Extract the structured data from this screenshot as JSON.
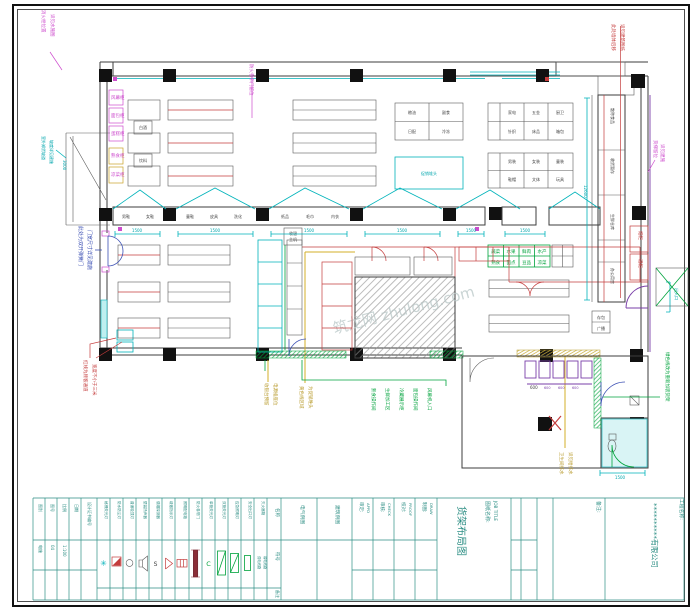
{
  "colors": {
    "wall": "#3d3d3d",
    "red": "#c43c3c",
    "cyan": "#00b3ba",
    "green": "#00a33c",
    "yellow": "#d3af2a",
    "magenta": "#cd4ccd",
    "purple": "#7a3fa8",
    "blue": "#3c50b4",
    "teal": "#2e8f85"
  },
  "tb": {
    "company": "**********有限公司",
    "project_label": "工程名称:",
    "name_label": "图纸名称:",
    "name_label_en": "JOB TITLE",
    "title": "货架布局图",
    "note_label": "备注:",
    "signs": [
      {
        "cn": "审定:",
        "en": "APPD"
      },
      {
        "cn": "审核:",
        "en": "CHECK"
      },
      {
        "cn": "校对:",
        "en": "PROOF"
      },
      {
        "cn": "制图:",
        "en": "DRAW"
      }
    ],
    "examples": [
      "电气例图",
      "建筑例图"
    ],
    "info_labels": [
      "图别",
      "图号",
      "比例",
      "日期"
    ],
    "info_values": [
      "电施",
      "04",
      "1:100",
      ""
    ],
    "cert": "设计证书编号"
  },
  "lg": {
    "name_label": "名称",
    "symbol_label": "符号",
    "remark_label": "备注",
    "items": [
      "格栅荧光灯",
      "防水防尘灯",
      "普通吸顶灯",
      "壁装扬声器",
      "感烟探测器",
      "疏散指示灯",
      "照明配电箱",
      "防火卷帘门",
      "单管荧光灯",
      "双管荧光灯",
      "应急照明灯",
      "安全出口灯",
      "灭火器箱"
    ],
    "extra": [
      "强电线路",
      "弱电线路"
    ]
  },
  "an": {
    "tl1": "消火栓位置",
    "tl2": "详见水施图",
    "lc1": "室外卸货坡道",
    "lc2": "坡度详见建施",
    "lb1": "此处为双开弹簧门",
    "lb2": "门宽尺寸详见建施",
    "lr1": "红线为顾客通道",
    "lr2": "宽度不小于三米",
    "tc1": "防火卷帘门留位",
    "tr1": "此处墙体后移",
    "tr2": "详见建筑图纸",
    "rm1": "货梯留位",
    "rm2": "详见建施",
    "rg1": "绿色线改为重新加装货架",
    "rdoor": "出入口",
    "bg": [
      "熟食操作间",
      "生鲜加工区",
      "冷藏展示柜",
      "面包操作间",
      "风幕机入口"
    ],
    "by": [
      "收银台预留",
      "电源插座位",
      "黄色线区域",
      "为促销堆头"
    ],
    "ay": [
      "卫生间排水",
      "详见给排水"
    ]
  },
  "lb": {
    "c": [
      "男鞋",
      "女鞋",
      "童鞋",
      "皮具",
      "洗化",
      "纸品",
      "毛巾",
      "内衣"
    ],
    "sv": [
      "散称食品",
      "收货暂存",
      "生鲜仓库",
      "办公用房"
    ],
    "g1": [
      "粮油",
      "副食",
      "日配",
      "冷冻"
    ],
    "g2": [
      "家电",
      "五金",
      "厨卫",
      "针织",
      "床品",
      "箱包"
    ],
    "g3": [
      "男装",
      "女装",
      "童装",
      "鞋帽",
      "文体",
      "玩具"
    ],
    "g4": [
      "蔬菜",
      "水果",
      "鲜肉",
      "水产",
      "熟食",
      "面点",
      "豆品",
      "凉菜"
    ],
    "sp": [
      "存包",
      "广播"
    ],
    "rb": [
      "烟柜",
      "酒柜"
    ],
    "pk": [
      "风幕柜",
      "面包柜",
      "蛋糕柜",
      "熟食柜",
      "凉菜柜"
    ],
    "bx": [
      "白酒",
      "饮料"
    ],
    "sb1": "收银",
    "sb2": "主机",
    "cybox": "促销堆头"
  },
  "dm": {
    "d1500": "1500",
    "d3000": "3000",
    "d12600": "12600",
    "dax": "1500",
    "d600": "600"
  },
  "wm": "筑龙网 zhulong.com"
}
